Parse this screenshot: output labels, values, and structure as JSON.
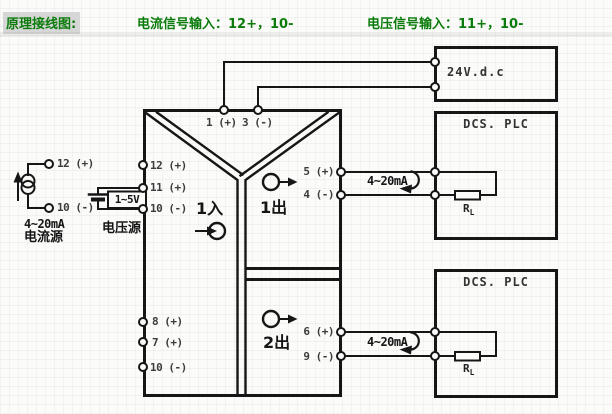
{
  "colors": {
    "accent_green": "#0b7c0b",
    "line_black": "#161616",
    "terminal_text": "#3c3c3c",
    "title_highlight_bg": "#d6d6d6"
  },
  "header": {
    "title": "原理接线图:",
    "current_note": "电流信号输入：12+，10-",
    "voltage_note": "电压信号输入：11+，10-"
  },
  "current_source": {
    "terminal_top": "12 (+)",
    "terminal_bottom": "10 (-)",
    "range": "4~20mA",
    "label": "电流源"
  },
  "voltage_source": {
    "range": "1~5V",
    "label": "电压源"
  },
  "isolator": {
    "power_terminal_1": "1 (+)",
    "power_terminal_2": "3 (-)",
    "left_terminals": [
      "12 (+)",
      "11 (+)",
      "10 (-)",
      "8 (+)",
      "7 (+)",
      "10 (-)"
    ],
    "right_terminals": [
      "5 (+)",
      "4 (-)",
      "6 (+)",
      "9 (-)"
    ],
    "input1": "1入",
    "output1": "1出",
    "output2": "2出"
  },
  "power_supply": {
    "label": "24V.d.c"
  },
  "dcs1": {
    "title": "DCS. PLC",
    "signal": "4~20mA",
    "load_base": "R",
    "load_sub": "L"
  },
  "dcs2": {
    "title": "DCS. PLC",
    "signal": "4~20mA",
    "load_base": "R",
    "load_sub": "L"
  }
}
